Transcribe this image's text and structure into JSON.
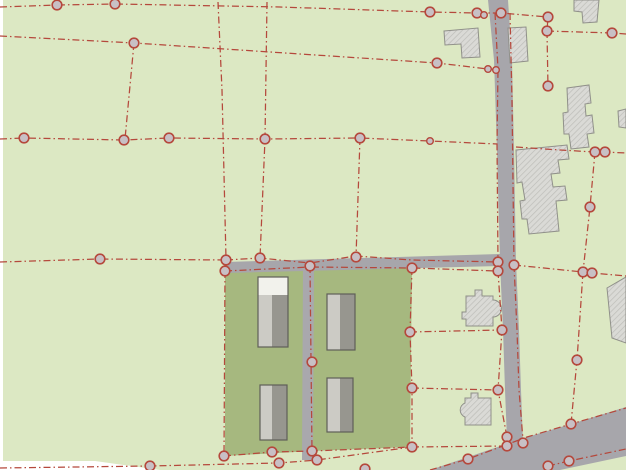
{
  "map": {
    "kind": "cadastral-parcel-map",
    "width": 626,
    "height": 470,
    "colors": {
      "background": "#dce8c3",
      "parcel_selected": "#a6b87f",
      "road": "#a7a6ab",
      "path": "#a9a8ad",
      "boundary_line": "#b5483c",
      "vertex_fill": "#c8c0c5",
      "vertex_stroke": "#b5483c",
      "hatch_fill": "#dadad6",
      "hatch_line": "#bdbdb8",
      "hatch_outline": "#90908a",
      "block_light": "#cccbc5",
      "block_dark": "#97968f",
      "block_white": "#f2f2ec",
      "block_outline": "#5f5e58",
      "margin_white": "#ffffff"
    },
    "margins": [
      {
        "points": [
          [
            0,
            0
          ],
          [
            3,
            0
          ],
          [
            3,
            470
          ],
          [
            0,
            470
          ]
        ]
      },
      {
        "points": [
          [
            0,
            461
          ],
          [
            95,
            461
          ],
          [
            160,
            470
          ],
          [
            0,
            470
          ]
        ]
      }
    ],
    "parcels": [
      {
        "points": [
          [
            225,
            272
          ],
          [
            412,
            268
          ],
          [
            410,
            447
          ],
          [
            312,
            451
          ],
          [
            225,
            456
          ]
        ]
      }
    ],
    "roads": [
      {
        "name": "road-horizontal",
        "points": [
          [
            225,
            262
          ],
          [
            500,
            254
          ],
          [
            500,
            266
          ],
          [
            225,
            273
          ]
        ]
      },
      {
        "name": "road-vertical",
        "points": [
          [
            488,
            0
          ],
          [
            508,
            0
          ],
          [
            512,
            60
          ],
          [
            514,
            150
          ],
          [
            516,
            262
          ],
          [
            519,
            330
          ],
          [
            521,
            390
          ],
          [
            523,
            442
          ],
          [
            510,
            447
          ],
          [
            507,
            440
          ],
          [
            505,
            390
          ],
          [
            503,
            330
          ],
          [
            500,
            262
          ],
          [
            497,
            150
          ],
          [
            494,
            60
          ]
        ]
      },
      {
        "name": "road-diagonal",
        "points": [
          [
            430,
            470
          ],
          [
            527,
            437
          ],
          [
            571,
            424
          ],
          [
            626,
            407
          ],
          [
            626,
            456
          ],
          [
            560,
            470
          ]
        ]
      },
      {
        "name": "parcel-path",
        "points": [
          [
            303,
            267
          ],
          [
            314,
            267
          ],
          [
            313,
            460
          ],
          [
            302,
            460
          ]
        ]
      }
    ],
    "hatched_buildings": [
      {
        "d": "M444,31 L478,28 L480,57 L462,58 L461,44 L445,45 Z"
      },
      {
        "d": "M508,28 L526,27 L528,61 L510,63 Z"
      },
      {
        "d": "M574,0 L599,0 L597,22 L583,23 L582,12 L574,11 Z"
      },
      {
        "d": "M567,88 L589,85 L591,103 L585,104 L586,116 L592,115 L594,133 L587,134 L589,147 L571,149 L569,134 L564,134 L563,113 L568,112 Z"
      },
      {
        "d": "M516,150 L567,145 L569,159 L558,160 L560,173 L551,174 L553,187 L565,186 L567,200 L556,201 L559,231 L529,234 L527,219 L522,219 L520,201 L525,200 L522,182 L517,183 Z"
      },
      {
        "d": "M618,111 L626,109 L626,128 L619,127 Z"
      },
      {
        "d": "M607,288 L626,277 L626,343 L612,338 Z"
      },
      {
        "d": "M466,296 L475,296 L475,290 L482,290 L482,296 L493,296 L493,300 A8.5,8.5 0 0 1 493,317 L493,326 L466,326 L466,319 L462,319 L462,312 L466,312 Z"
      },
      {
        "d": "M471,398 L471,393 L478,393 L478,398 L491,398 L491,425 L465,425 L465,417 A7.5,7.5 0 0 1 465,403 L465,398 Z"
      }
    ],
    "block_buildings": [
      {
        "x": 258,
        "y": 277,
        "w": 30,
        "h": 70,
        "split": 14,
        "white_top": 18
      },
      {
        "x": 327,
        "y": 294,
        "w": 28,
        "h": 56,
        "split": 13,
        "white_top": 0
      },
      {
        "x": 260,
        "y": 385,
        "w": 27,
        "h": 55,
        "split": 12,
        "white_top": 0
      },
      {
        "x": 327,
        "y": 378,
        "w": 26,
        "h": 54,
        "split": 13,
        "white_top": 0
      }
    ],
    "boundaries": [
      {
        "points": [
          [
            0,
            7
          ],
          [
            57,
            5
          ],
          [
            115,
            4
          ],
          [
            280,
            7
          ],
          [
            430,
            12
          ],
          [
            477,
            13
          ],
          [
            501,
            13
          ],
          [
            548,
            17
          ],
          [
            547,
            31
          ]
        ]
      },
      {
        "points": [
          [
            547,
            31
          ],
          [
            612,
            33
          ],
          [
            626,
            34
          ]
        ]
      },
      {
        "points": [
          [
            0,
            36
          ],
          [
            134,
            43
          ],
          [
            300,
            54
          ],
          [
            437,
            63
          ],
          [
            488,
            69
          ],
          [
            497,
            70
          ]
        ]
      },
      {
        "points": [
          [
            134,
            43
          ],
          [
            125,
            139
          ]
        ]
      },
      {
        "points": [
          [
            0,
            139
          ],
          [
            24,
            138
          ],
          [
            124,
            140
          ],
          [
            169,
            138
          ],
          [
            265,
            139
          ],
          [
            360,
            138
          ],
          [
            430,
            141
          ],
          [
            497,
            144
          ]
        ]
      },
      {
        "points": [
          [
            516,
            147
          ],
          [
            560,
            150
          ],
          [
            595,
            152
          ],
          [
            605,
            152
          ],
          [
            626,
            153
          ]
        ]
      },
      {
        "points": [
          [
            595,
            152
          ],
          [
            590,
            207
          ],
          [
            583,
            272
          ]
        ]
      },
      {
        "points": [
          [
            218,
            2
          ],
          [
            222,
            90
          ],
          [
            226,
            259
          ]
        ]
      },
      {
        "points": [
          [
            267,
            2
          ],
          [
            265,
            139
          ],
          [
            260,
            258
          ]
        ]
      },
      {
        "points": [
          [
            360,
            138
          ],
          [
            356,
            257
          ]
        ]
      },
      {
        "points": [
          [
            0,
            262
          ],
          [
            100,
            259
          ],
          [
            226,
            260
          ]
        ]
      },
      {
        "points": [
          [
            226,
            260
          ],
          [
            260,
            258
          ],
          [
            310,
            263
          ],
          [
            356,
            256
          ],
          [
            412,
            260
          ],
          [
            498,
            262
          ]
        ]
      },
      {
        "points": [
          [
            225,
            271
          ],
          [
            310,
            267
          ],
          [
            412,
            268
          ],
          [
            498,
            271
          ]
        ]
      },
      {
        "points": [
          [
            514,
            265
          ],
          [
            583,
            272
          ],
          [
            592,
            273
          ],
          [
            626,
            276
          ]
        ]
      },
      {
        "points": [
          [
            583,
            272
          ],
          [
            577,
            360
          ],
          [
            571,
            424
          ]
        ]
      },
      {
        "points": [
          [
            410,
            332
          ],
          [
            502,
            330
          ]
        ]
      },
      {
        "points": [
          [
            412,
            388
          ],
          [
            498,
            390
          ]
        ]
      },
      {
        "points": [
          [
            225,
            271
          ],
          [
            224,
            456
          ]
        ]
      },
      {
        "points": [
          [
            412,
            268
          ],
          [
            410,
            332
          ],
          [
            412,
            388
          ],
          [
            412,
            447
          ]
        ]
      },
      {
        "points": [
          [
            224,
            456
          ],
          [
            272,
            452
          ],
          [
            312,
            451
          ],
          [
            412,
            447
          ]
        ]
      },
      {
        "points": [
          [
            310,
            266
          ],
          [
            311,
            360
          ],
          [
            312,
            451
          ]
        ]
      },
      {
        "points": [
          [
            0,
            468
          ],
          [
            150,
            466
          ],
          [
            279,
            463
          ],
          [
            317,
            460
          ],
          [
            412,
            447
          ]
        ]
      },
      {
        "points": [
          [
            412,
            447
          ],
          [
            507,
            446
          ]
        ]
      },
      {
        "points": [
          [
            430,
            470
          ],
          [
            468,
            459
          ],
          [
            527,
            437
          ],
          [
            571,
            424
          ],
          [
            626,
            408
          ]
        ]
      },
      {
        "points": [
          [
            548,
            466
          ],
          [
            569,
            461
          ],
          [
            626,
            449
          ]
        ]
      },
      {
        "points": [
          [
            495,
            13
          ],
          [
            498,
            69
          ],
          [
            497,
            144
          ],
          [
            498,
            262
          ]
        ]
      },
      {
        "points": [
          [
            498,
            271
          ],
          [
            502,
            330
          ],
          [
            498,
            390
          ],
          [
            507,
            437
          ]
        ]
      },
      {
        "points": [
          [
            510,
            13
          ],
          [
            512,
            100
          ],
          [
            514,
            265
          ]
        ]
      },
      {
        "points": [
          [
            514,
            265
          ],
          [
            517,
            330
          ],
          [
            519,
            390
          ],
          [
            523,
            440
          ]
        ]
      },
      {
        "points": [
          [
            547,
            31
          ],
          [
            548,
            88
          ]
        ]
      }
    ],
    "vertices": [
      [
        57,
        5
      ],
      [
        115,
        4
      ],
      [
        430,
        12
      ],
      [
        477,
        13
      ],
      [
        501,
        13
      ],
      [
        548,
        17
      ],
      [
        547,
        31
      ],
      [
        612,
        33
      ],
      [
        134,
        43
      ],
      [
        437,
        63
      ],
      [
        24,
        138
      ],
      [
        124,
        140
      ],
      [
        169,
        138
      ],
      [
        265,
        139
      ],
      [
        360,
        138
      ],
      [
        548,
        86
      ],
      [
        595,
        152
      ],
      [
        605,
        152
      ],
      [
        590,
        207
      ],
      [
        100,
        259
      ],
      [
        226,
        260
      ],
      [
        225,
        271
      ],
      [
        260,
        258
      ],
      [
        310,
        266
      ],
      [
        356,
        257
      ],
      [
        412,
        268
      ],
      [
        498,
        262
      ],
      [
        498,
        271
      ],
      [
        514,
        265
      ],
      [
        583,
        272
      ],
      [
        592,
        273
      ],
      [
        577,
        360
      ],
      [
        410,
        332
      ],
      [
        502,
        330
      ],
      [
        412,
        388
      ],
      [
        498,
        390
      ],
      [
        571,
        424
      ],
      [
        224,
        456
      ],
      [
        272,
        452
      ],
      [
        312,
        451
      ],
      [
        412,
        447
      ],
      [
        312,
        362
      ],
      [
        150,
        466
      ],
      [
        279,
        463
      ],
      [
        317,
        460
      ],
      [
        365,
        469
      ],
      [
        507,
        437
      ],
      [
        507,
        446
      ],
      [
        523,
        443
      ],
      [
        468,
        459
      ],
      [
        548,
        466
      ],
      [
        569,
        461
      ]
    ],
    "vertices_small": [
      [
        484,
        15
      ],
      [
        488,
        69
      ],
      [
        496,
        70
      ],
      [
        430,
        141
      ]
    ]
  }
}
